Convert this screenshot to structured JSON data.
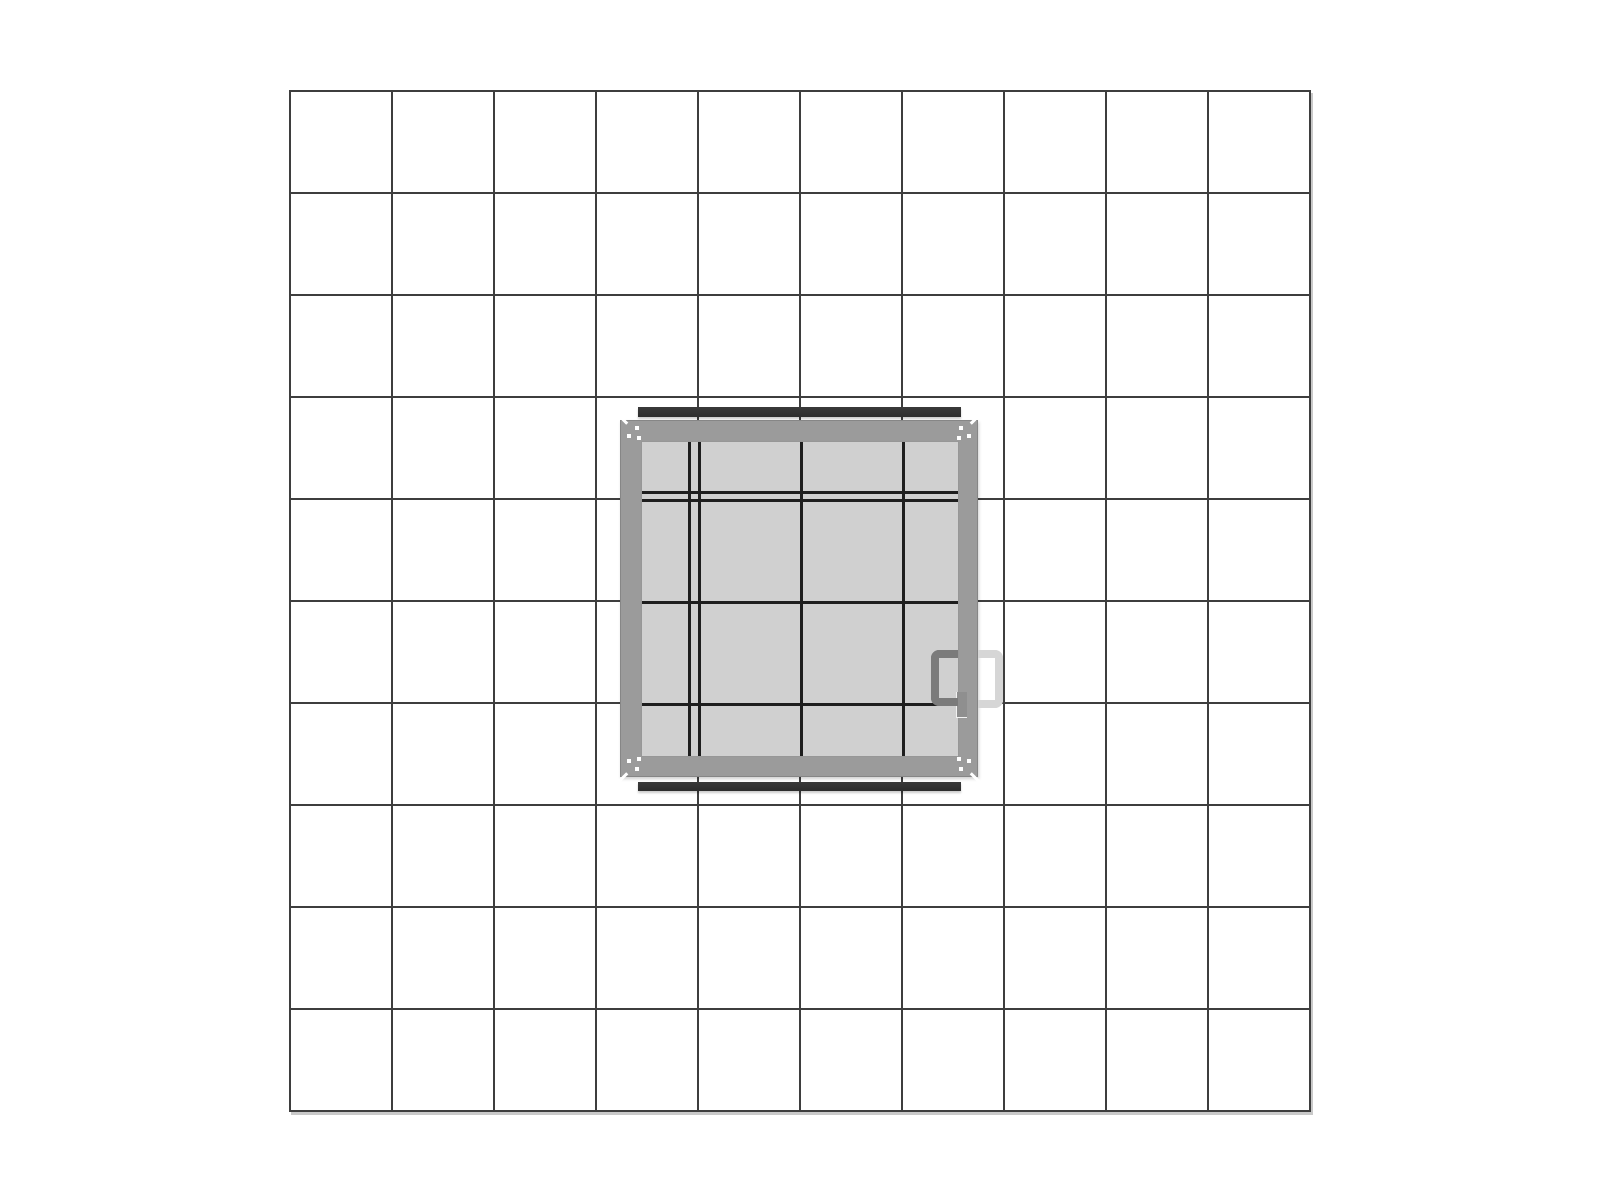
{
  "scene": {
    "type": "technical-drawing",
    "subject": "hatch-panel-top-view-on-grid-paper",
    "visible_text": []
  },
  "grid": {
    "rows": 10,
    "columns": 10,
    "cell_size_px": 102,
    "line_width_px": 2
  },
  "panel": {
    "grid_cells_spanned": 3.5,
    "interior_divisions": {
      "columns": 4,
      "rows": 4
    },
    "parts": [
      "frame",
      "translucent-glass-interior",
      "top-flange-bar",
      "bottom-flange-bar",
      "corner-fastener-marks",
      "inner-handle",
      "outer-handle-ghost",
      "latch-plate"
    ]
  },
  "colors": {
    "background": "#ffffff",
    "grid_line": "#3e3e3e",
    "grid_shadow": "#c9c9c9",
    "frame": "#9b9b9b",
    "frame_edge": "#868686",
    "interior": "#d0d0d0",
    "interior_edge": "#979797",
    "interior_line": "#1e1e1e",
    "bar": "#2d2d2d",
    "handle_dark": "#7b7b7b",
    "handle_light": "#d6d6d6",
    "latch": "#8f8f8f",
    "mark": "#ffffff"
  }
}
